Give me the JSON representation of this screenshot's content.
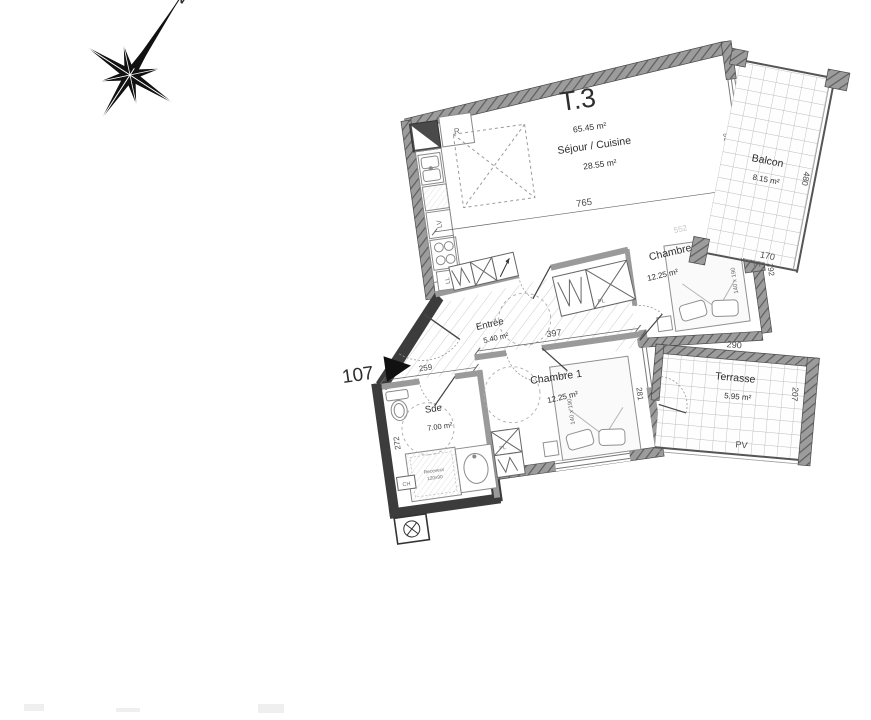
{
  "plan": {
    "unit": {
      "title": "T.3",
      "area": "65.45 m²",
      "lot": "107"
    },
    "rooms": {
      "sejour": {
        "name": "Séjour / Cuisine",
        "area": "28.55 m²"
      },
      "chambre1": {
        "name": "Chambre 1",
        "area": "12.25 m²",
        "bed": "140 x 190"
      },
      "chambre2": {
        "name": "Chambre 2",
        "area": "12.25 m²",
        "bed": "140 x 190"
      },
      "sde": {
        "name": "Sde",
        "area": "7.00 m²",
        "shower_line1": "Receveur",
        "shower_line2": "120x90"
      },
      "entree": {
        "name": "Entrée",
        "area": "5.40 m²"
      },
      "balcon": {
        "name": "Balcon",
        "area": "8.15 m²"
      },
      "terrasse": {
        "name": "Terrasse",
        "area": "5.95 m²"
      }
    },
    "dims": {
      "sejour_w": "765",
      "bay_h": "196",
      "sejour_wall": "552",
      "chambre2_h": "292",
      "terrasse_w": "290",
      "terrasse_h": "207",
      "balcon_h": "480",
      "balcon_w": "170",
      "chambre1_w": "397",
      "chambre1_h": "281",
      "sde_w": "259",
      "sde_h": "272"
    },
    "labels": {
      "fridge": "R",
      "dishwasher": "LV",
      "washer": "LL",
      "closet": "PL",
      "boiler": "CH",
      "shutter": "VR",
      "glazing": "PV",
      "sliding": "coulissante",
      "north": "N"
    },
    "colors": {
      "wall_gray": "#9a9a9a",
      "wall_dark": "#3c3c3c",
      "text": "#2e2e2e"
    }
  }
}
